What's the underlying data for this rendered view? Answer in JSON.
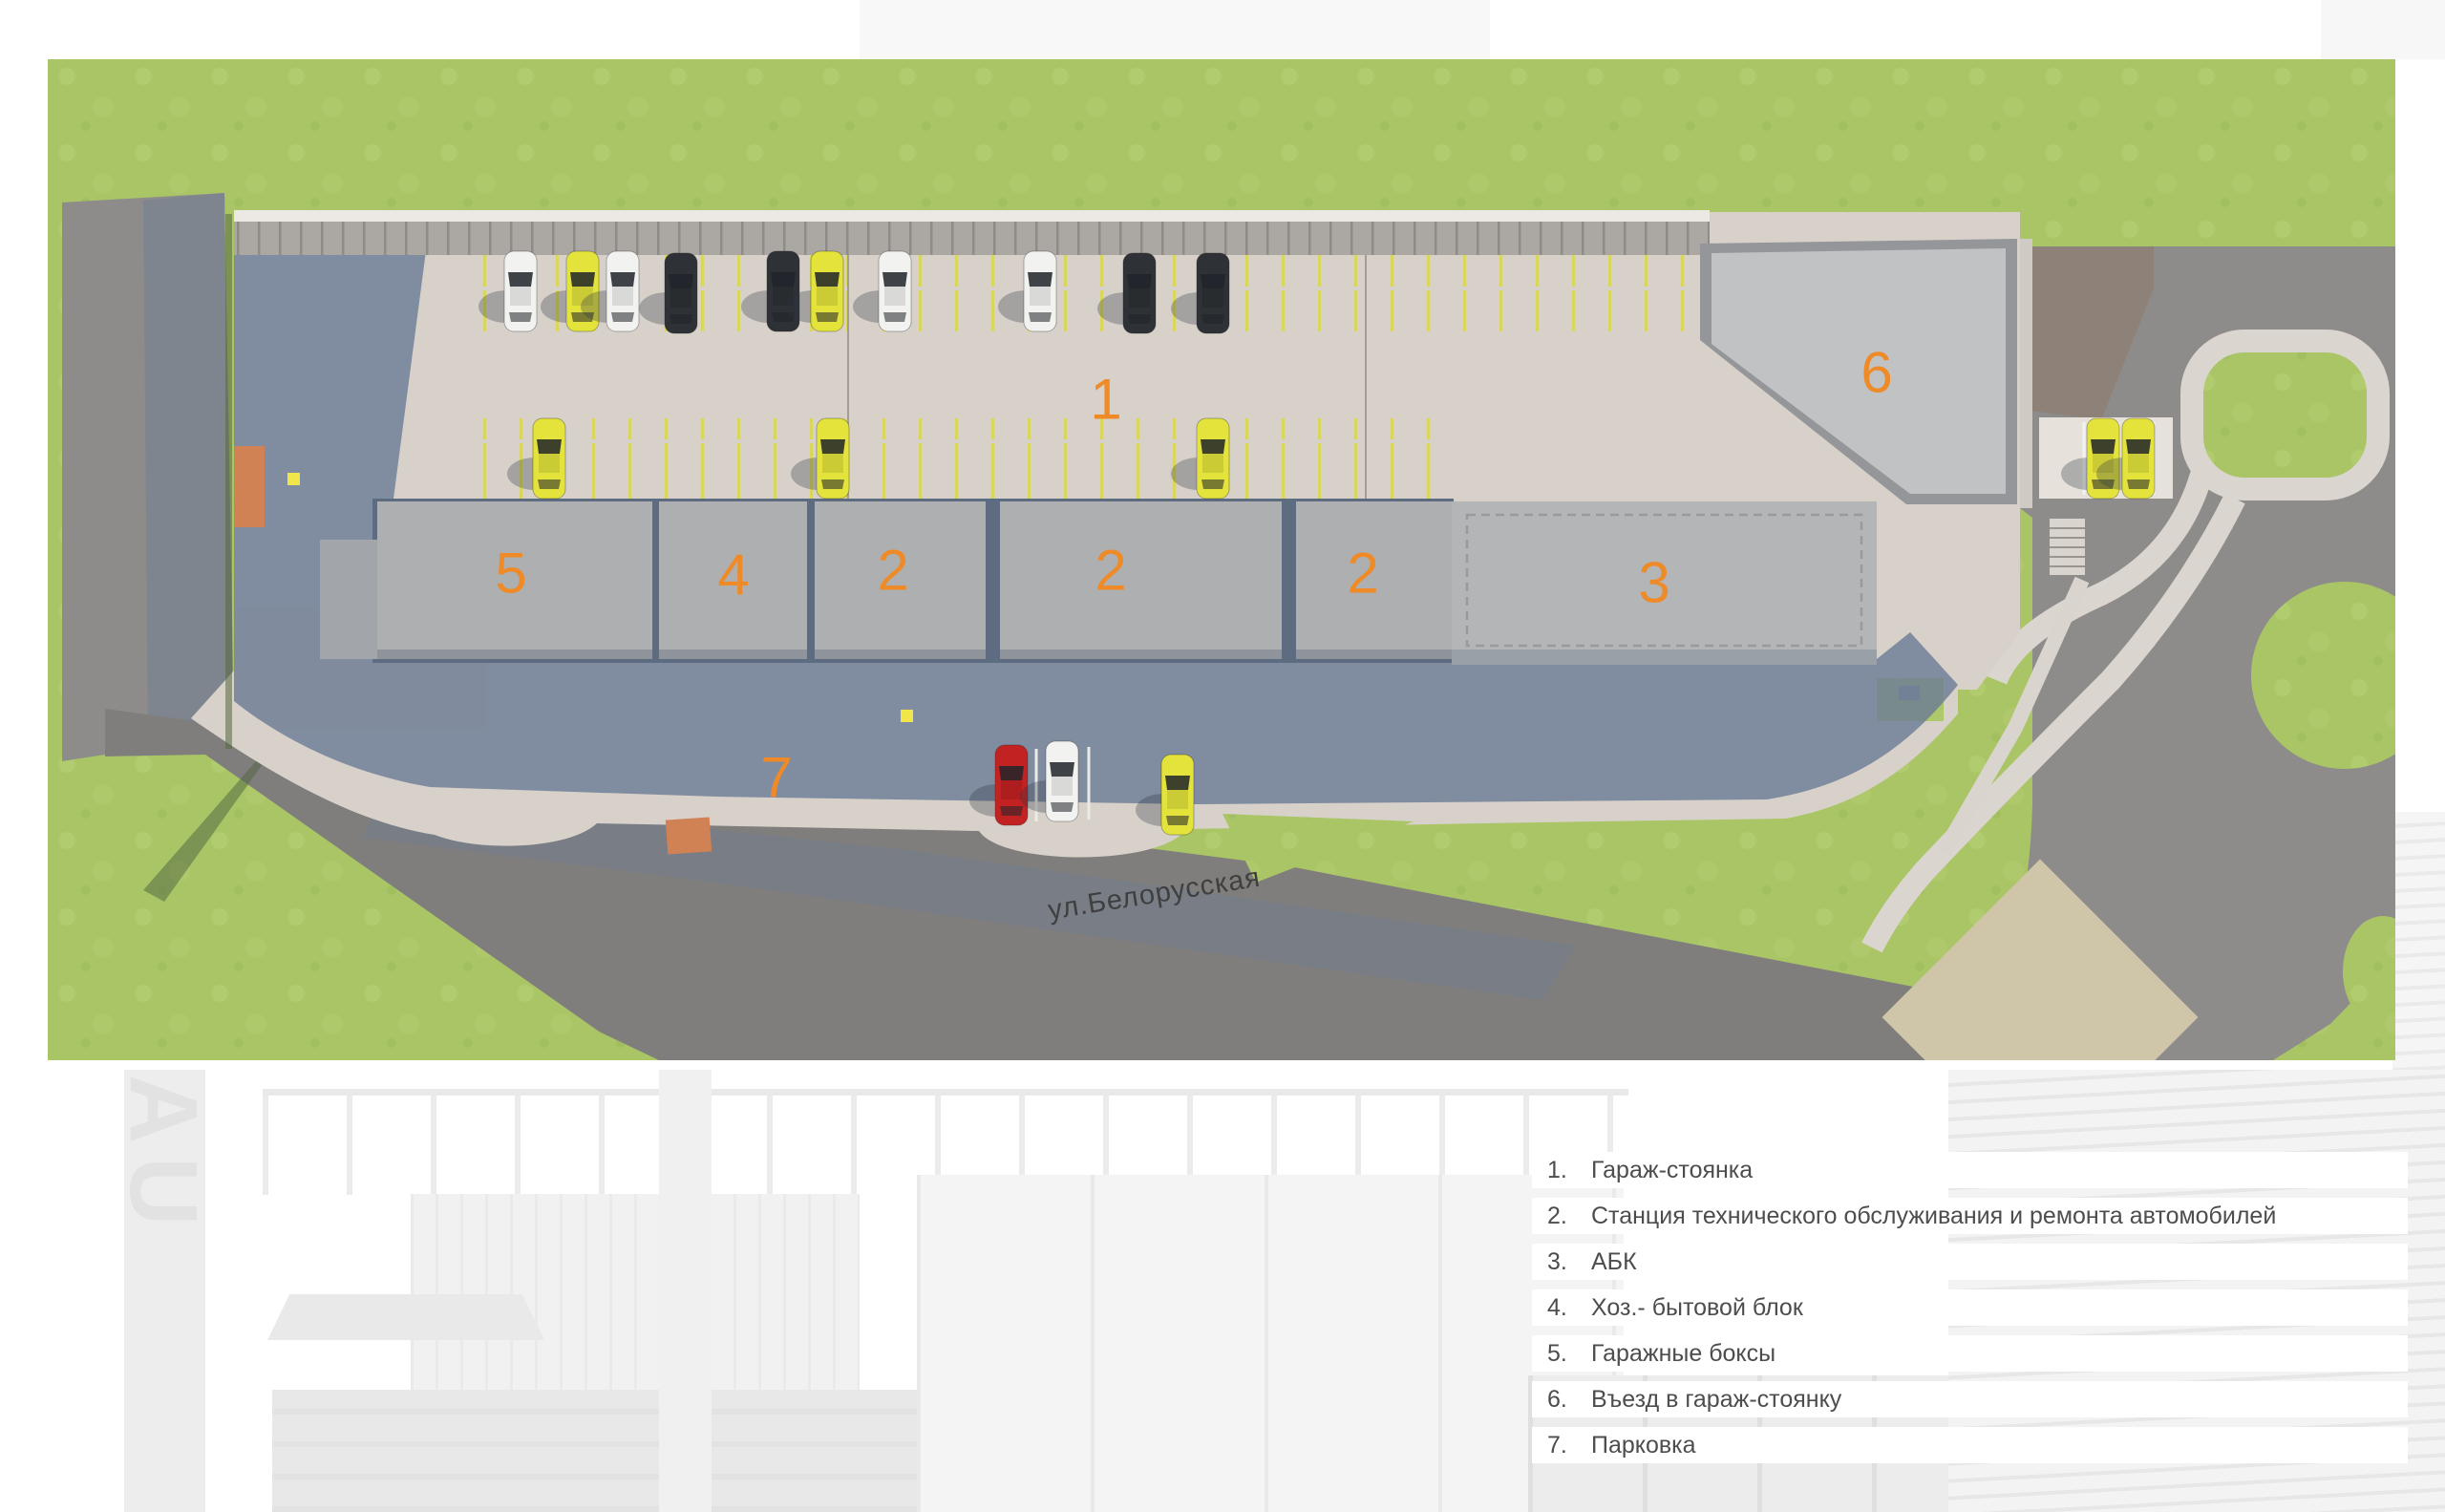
{
  "plan": {
    "street_label": "ул.Белорусская",
    "markers": [
      {
        "id": "area-1",
        "label": "1"
      },
      {
        "id": "area-5",
        "label": "5"
      },
      {
        "id": "area-4",
        "label": "4"
      },
      {
        "id": "area-2a",
        "label": "2"
      },
      {
        "id": "area-2b",
        "label": "2"
      },
      {
        "id": "area-2c",
        "label": "2"
      },
      {
        "id": "area-3",
        "label": "3"
      },
      {
        "id": "area-6",
        "label": "6"
      },
      {
        "id": "area-7",
        "label": "7"
      }
    ]
  },
  "legend": {
    "items": [
      {
        "num": "1.",
        "text": "Гараж-стоянка"
      },
      {
        "num": "2.",
        "text": "Станция технического обслуживания и ремонта автомобилей"
      },
      {
        "num": "3.",
        "text": "АБК"
      },
      {
        "num": "4.",
        "text": "Хоз.- бытовой блок"
      },
      {
        "num": "5.",
        "text": "Гаражные боксы"
      },
      {
        "num": "6.",
        "text": "Въезд в гараж-стоянку"
      },
      {
        "num": "7.",
        "text": "Парковка"
      }
    ]
  },
  "backdrop": {
    "signage": "AU"
  },
  "colors": {
    "accent_orange": "#ee8b28",
    "grass": "#a9c566",
    "asphalt": "#858483",
    "pavement": "#d7d1ca",
    "roof_gray": "#adafb1",
    "shadow_blue": "#6d7d95",
    "car_yellow": "#e3e33b",
    "car_dark": "#2e3135",
    "car_red": "#c32222",
    "car_white": "#f2f2f0",
    "terracotta": "#d08254",
    "legend_text": "#4d4d4d"
  }
}
